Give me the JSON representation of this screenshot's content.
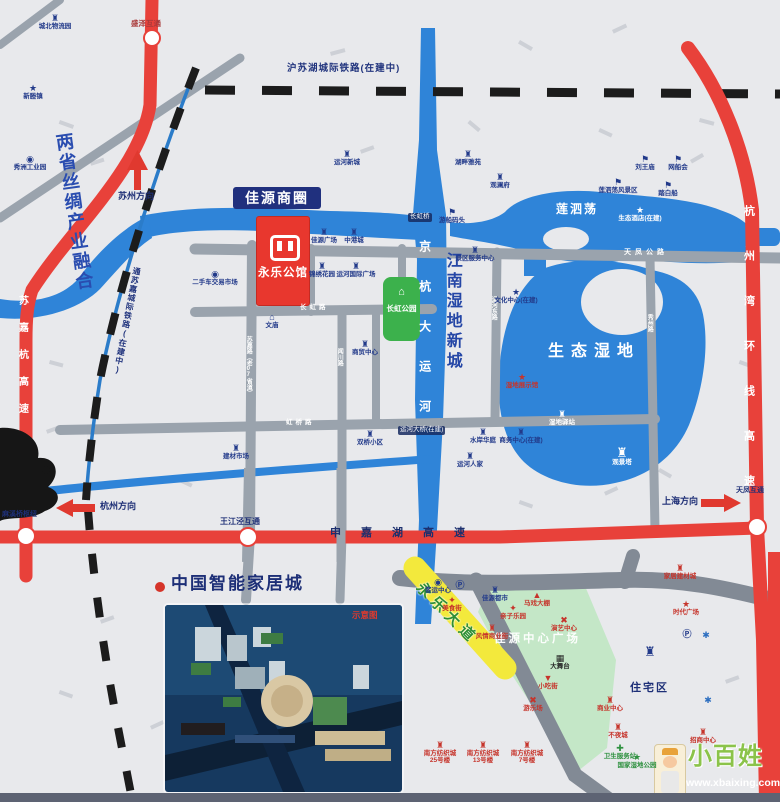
{
  "colors": {
    "accent_red": "#e8413a",
    "navy_text": "#1e2f76",
    "water_blue": "#2f84d8",
    "park_green": "#3cb14c",
    "zone_green": "#c4e7c7",
    "road_gray": "#9aa3ad",
    "yellow_road": "#f3e93c",
    "rail_black": "#1c1c1c",
    "background": "#e8e9ec"
  },
  "regions": {
    "silk_slogan": "两省丝绸产业融合",
    "business_circle": "佳源商圈",
    "project_name": "永乐公馆",
    "park": "长虹公园",
    "wetland_city": "江南湿地新城",
    "lake": "莲泗荡",
    "eco_wetland": "生态湿地",
    "plaza_zone": "佳源中心广场",
    "residential": "住宅区"
  },
  "smart_home": {
    "title": "中国智能家居城",
    "inset_tag": "示意图"
  },
  "roads": {
    "canal": "京杭大运河",
    "hangzhou_bay_hwy": "杭州湾环线高速",
    "sujiahang_hwy": "苏嘉杭高速",
    "shenjiahu_hwy": "申嘉湖高速",
    "tianfeng_rd": "天凤公路",
    "sujia_rd": "苏嘉路（老07省道）",
    "wenchuan_rd": "闻川路",
    "changhong_rd": "长虹路",
    "hongqiao_rd": "虹桥路",
    "yunhe_east_rd": "运河东路",
    "xiuzhou_rd": "秀州路",
    "yellow_rd": "永乐大道"
  },
  "railways": {
    "hsh": "沪苏湖城际铁路(在建中)",
    "tsj": "通苏嘉城际铁路(在建中)"
  },
  "junctions": {
    "shengze": "盛泽互通",
    "wangjiangjing": "王江泾互通",
    "tianfeng": "天凤互通",
    "hub": "麻溪桥枢纽"
  },
  "bridges": {
    "changhong": "长虹桥",
    "yunhe": "运河大桥(在建)"
  },
  "directions": {
    "suzhou": "苏州方向",
    "hangzhou": "杭州方向",
    "shanghai": "上海方向"
  },
  "watermark": {
    "brand": "小百姓",
    "url": "www.xbaixing.com"
  },
  "pois": [
    {
      "x": 55,
      "y": 14,
      "icon": "buildings",
      "label": "城北物流园",
      "color": "navy"
    },
    {
      "x": 33,
      "y": 84,
      "icon": "star",
      "label": "新塍镇",
      "color": "navy"
    },
    {
      "x": 30,
      "y": 155,
      "icon": "flower",
      "label": "秀洲工业园",
      "color": "navy"
    },
    {
      "x": 215,
      "y": 270,
      "icon": "flower",
      "label": "二手车交易市场",
      "color": "navy"
    },
    {
      "x": 347,
      "y": 150,
      "icon": "buildings",
      "label": "运河新城",
      "color": "navy"
    },
    {
      "x": 324,
      "y": 228,
      "icon": "buildings",
      "label": "佳源广场",
      "color": "navy"
    },
    {
      "x": 354,
      "y": 228,
      "icon": "buildings",
      "label": "中港城",
      "color": "navy"
    },
    {
      "x": 322,
      "y": 262,
      "icon": "buildings",
      "label": "锦绣花园",
      "color": "navy"
    },
    {
      "x": 356,
      "y": 262,
      "icon": "buildings",
      "label": "运河国际广场",
      "color": "navy"
    },
    {
      "x": 272,
      "y": 313,
      "icon": "temple",
      "label": "文庙",
      "color": "navy"
    },
    {
      "x": 365,
      "y": 340,
      "icon": "buildings",
      "label": "商贸中心",
      "color": "navy"
    },
    {
      "x": 236,
      "y": 444,
      "icon": "buildings",
      "label": "建材市场",
      "color": "navy"
    },
    {
      "x": 370,
      "y": 430,
      "icon": "buildings",
      "label": "双桥小区",
      "color": "navy"
    },
    {
      "x": 516,
      "y": 288,
      "icon": "star",
      "label": "文化中心(在建)",
      "color": "navy"
    },
    {
      "x": 522,
      "y": 373,
      "icon": "star",
      "label": "湿地展示馆",
      "color": "red"
    },
    {
      "x": 483,
      "y": 428,
      "icon": "buildings",
      "label": "水岸华庭",
      "color": "navy"
    },
    {
      "x": 521,
      "y": 428,
      "icon": "buildings",
      "label": "商务中心(在建)",
      "color": "navy"
    },
    {
      "x": 470,
      "y": 452,
      "icon": "buildings",
      "label": "运河人家",
      "color": "navy"
    },
    {
      "x": 468,
      "y": 150,
      "icon": "buildings",
      "label": "湖畔雅苑",
      "color": "navy"
    },
    {
      "x": 500,
      "y": 173,
      "icon": "buildings",
      "label": "观澜府",
      "color": "navy"
    },
    {
      "x": 452,
      "y": 208,
      "icon": "boat",
      "label": "游船码头",
      "color": "navy"
    },
    {
      "x": 475,
      "y": 246,
      "icon": "buildings",
      "label": "景区服务中心",
      "color": "navy"
    },
    {
      "x": 645,
      "y": 155,
      "icon": "boat",
      "label": "刘王庙",
      "color": "navy"
    },
    {
      "x": 678,
      "y": 155,
      "icon": "boat",
      "label": "网船会",
      "color": "navy"
    },
    {
      "x": 618,
      "y": 178,
      "icon": "boat",
      "label": "莲泗荡风景区",
      "color": "navy"
    },
    {
      "x": 668,
      "y": 181,
      "icon": "boat",
      "label": "踏白船",
      "color": "navy"
    },
    {
      "x": 640,
      "y": 206,
      "icon": "star",
      "label": "生态酒店(在建)",
      "color": "white"
    },
    {
      "x": 562,
      "y": 410,
      "icon": "buildings",
      "label": "湿地驿站",
      "color": "white"
    },
    {
      "x": 622,
      "y": 446,
      "icon": "tower",
      "label": "观景塔",
      "color": "white"
    },
    {
      "x": 438,
      "y": 578,
      "icon": "flower",
      "label": "客运中心",
      "color": "navy"
    },
    {
      "x": 460,
      "y": 581,
      "icon": "parking",
      "label": "",
      "color": "navy"
    },
    {
      "x": 452,
      "y": 596,
      "icon": "food",
      "label": "美食街",
      "color": "red"
    },
    {
      "x": 495,
      "y": 586,
      "icon": "buildings",
      "label": "佳源都市",
      "color": "navy"
    },
    {
      "x": 537,
      "y": 591,
      "icon": "tent",
      "label": "马戏大棚",
      "color": "red"
    },
    {
      "x": 513,
      "y": 604,
      "icon": "food",
      "label": "亲子乐园",
      "color": "red"
    },
    {
      "x": 492,
      "y": 624,
      "icon": "buildings",
      "label": "风情商业街",
      "color": "red"
    },
    {
      "x": 564,
      "y": 616,
      "icon": "games",
      "label": "演艺中心",
      "color": "red"
    },
    {
      "x": 560,
      "y": 654,
      "icon": "stage",
      "label": "大舞台",
      "color": "dark"
    },
    {
      "x": 548,
      "y": 674,
      "icon": "cone",
      "label": "小吃街",
      "color": "red"
    },
    {
      "x": 533,
      "y": 696,
      "icon": "games",
      "label": "游乐场",
      "color": "red"
    },
    {
      "x": 610,
      "y": 696,
      "icon": "buildings",
      "label": "商业中心",
      "color": "red"
    },
    {
      "x": 618,
      "y": 723,
      "icon": "buildings",
      "label": "不夜城",
      "color": "red"
    },
    {
      "x": 620,
      "y": 744,
      "icon": "plus",
      "label": "卫生服务站",
      "color": "green"
    },
    {
      "x": 637,
      "y": 753,
      "icon": "star",
      "label": "国家湿地公园",
      "color": "green"
    },
    {
      "x": 440,
      "y": 741,
      "icon": "buildings",
      "label": "南方纺织城\n25号楼",
      "color": "red"
    },
    {
      "x": 483,
      "y": 741,
      "icon": "buildings",
      "label": "南方纺织城\n13号楼",
      "color": "red"
    },
    {
      "x": 527,
      "y": 741,
      "icon": "buildings",
      "label": "南方纺织城\n7号楼",
      "color": "red"
    },
    {
      "x": 680,
      "y": 564,
      "icon": "buildings",
      "label": "家居建材城",
      "color": "red"
    },
    {
      "x": 686,
      "y": 600,
      "icon": "star",
      "label": "时代广场",
      "color": "red"
    },
    {
      "x": 687,
      "y": 630,
      "icon": "parking",
      "label": "",
      "color": "navy"
    },
    {
      "x": 706,
      "y": 631,
      "icon": "knot",
      "label": "",
      "color": "blue"
    },
    {
      "x": 708,
      "y": 696,
      "icon": "knot",
      "label": "",
      "color": "blue"
    },
    {
      "x": 703,
      "y": 728,
      "icon": "buildings",
      "label": "招商中心",
      "color": "red"
    },
    {
      "x": 650,
      "y": 645,
      "icon": "tower",
      "label": "",
      "color": "navy"
    }
  ]
}
